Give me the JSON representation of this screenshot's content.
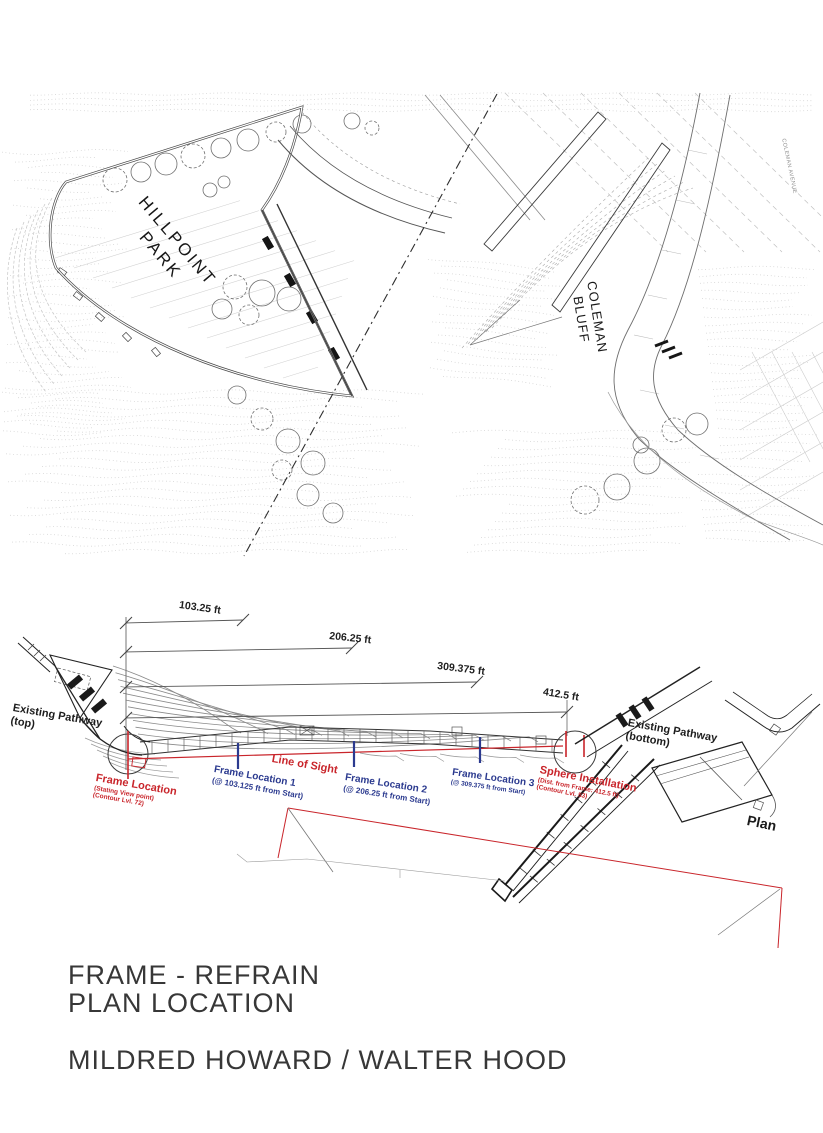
{
  "site_plan": {
    "park_label_line1": "HILLPOINT",
    "park_label_line2": "PARK",
    "bluff_label_line1": "COLEMAN",
    "bluff_label_line2": "BLUFF",
    "avenue_label": "COLEMAN AVENUE"
  },
  "plan_diagram": {
    "dim_103": "103.25 ft",
    "dim_206": "206.25 ft",
    "dim_309": "309.375 ft",
    "dim_412": "412.5 ft",
    "existing_pathway_top_line1": "Existing Pathway",
    "existing_pathway_top_line2": "(top)",
    "existing_pathway_bottom_line1": "Existing Pathway",
    "existing_pathway_bottom_line2": "(bottom)",
    "frame_location_start": {
      "title": "Frame Location",
      "sub1": "(Stating View point)",
      "sub2": "(Contour Lvl. 72)"
    },
    "line_of_sight": "Line of Sight",
    "frame_location_1": {
      "title": "Frame Location 1",
      "sub": "(@ 103.125 ft from Start)"
    },
    "frame_location_2": {
      "title": "Frame Location 2",
      "sub": "(@ 206.25 ft from Start)"
    },
    "frame_location_3": {
      "title": "Frame Location 3",
      "sub": "(@ 309.375 ft from Start)"
    },
    "sphere_installation": {
      "title": "Sphere Installation",
      "sub1": "(Dist. from Frame: 412.5 ft)",
      "sub2": "(Contour Lvl. 53)"
    },
    "plan_caption": "Plan",
    "colors": {
      "annotation_red": "#c9252b",
      "annotation_blue": "#2b3a8f",
      "linework": "#3d3d3d"
    }
  },
  "title_block": {
    "line1": "FRAME - REFRAIN",
    "line2": "PLAN LOCATION",
    "credit": "MILDRED HOWARD / WALTER HOOD"
  }
}
